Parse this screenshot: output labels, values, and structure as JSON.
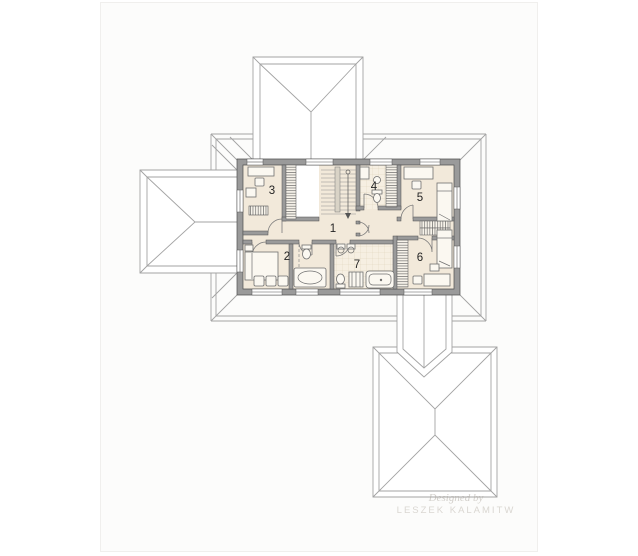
{
  "plan": {
    "type": "floor-plan-top-view",
    "room_labels": [
      "1",
      "2",
      "3",
      "4",
      "5",
      "6",
      "7"
    ],
    "watermark": {
      "line1": "Designed by",
      "line2": "LESZEK KALAMITW"
    },
    "colors": {
      "page_background": "#ffffff",
      "panel_background": "#fcfcfb",
      "floor": "#f2e9da",
      "tile_floor": "#f6efe2",
      "tile_line": "#ddd1b9",
      "wall": "#9a9a9a",
      "wall_edge": "#4f4f4f",
      "roof_line": "#a3a3a3",
      "furniture_line": "#6f6f6f",
      "label_text": "#242424",
      "void_opening": "#ffffff"
    }
  }
}
